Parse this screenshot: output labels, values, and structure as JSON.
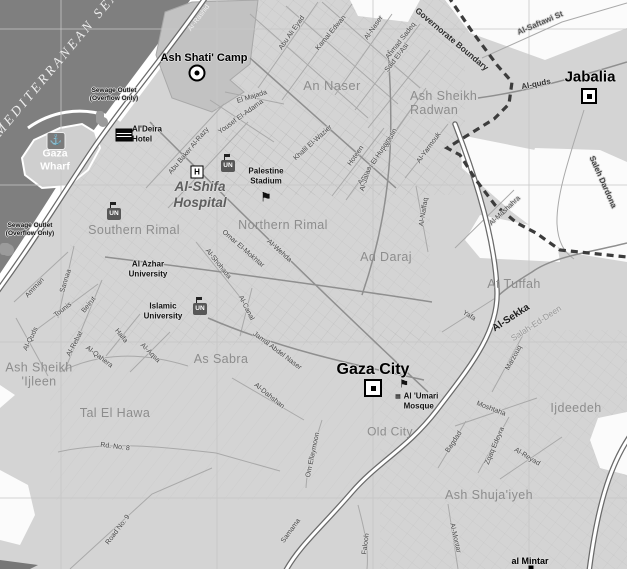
{
  "colors": {
    "sea": "#7f7f7f",
    "land": "#d4d4d4",
    "open_area": "#fbfbfb",
    "camp_area": "#c2c2c2",
    "boundary": "#3c3c3c",
    "major_road": "#ffffff",
    "district_label": "#8d8d8d"
  },
  "sea_label": "MEDITERRANEAN SEA",
  "boundary_label": "Governorate Boundary",
  "icon_labels": {
    "un": "UN",
    "h": "H"
  },
  "districts": [
    {
      "name": "An Naser"
    },
    {
      "name": "Ash Sheikh\nRadwan"
    },
    {
      "name": "Northern Rimal"
    },
    {
      "name": "Southern Rimal"
    },
    {
      "name": "Ad Daraj"
    },
    {
      "name": "At Tuffah"
    },
    {
      "name": "As Sabra"
    },
    {
      "name": "Tal El Hawa"
    },
    {
      "name": "Ash Sheikh\n'Ijleen"
    },
    {
      "name": "Old City"
    },
    {
      "name": "Ijdeedeh"
    },
    {
      "name": "Ash Shuja'iyeh"
    }
  ],
  "places": [
    {
      "name": "Ash Shati' Camp"
    },
    {
      "name": "Jabalia"
    },
    {
      "name": "Gaza City"
    },
    {
      "name": "al Mintar"
    }
  ],
  "pois": [
    {
      "name": "Al'Deira\nHotel"
    },
    {
      "name": "Gaza\nWharf"
    },
    {
      "name": "Sewage Outlet\n(Overflow Only)"
    },
    {
      "name": "Sewage Outlet\n(Overflow Only)"
    },
    {
      "name": "Palestine\nStadium"
    },
    {
      "name": "Al-Shifa\nHospital"
    },
    {
      "name": "Al Azhar\nUniversity"
    },
    {
      "name": "Islamic\nUniversity"
    },
    {
      "name": "Al 'Umari\nMosque"
    }
  ],
  "streets": [
    {
      "name": "Ar-Rashid"
    },
    {
      "name": "Abu Ali Eyad"
    },
    {
      "name": "Kamal Edwan"
    },
    {
      "name": "Al-Naser"
    },
    {
      "name": "Ahmad Sadeq"
    },
    {
      "name": "Said El-Asi"
    },
    {
      "name": "Al-Saftawi St"
    },
    {
      "name": "Al-quds"
    },
    {
      "name": "Saleh Dardona"
    },
    {
      "name": "El Majada"
    },
    {
      "name": "Yousef El-Adama"
    },
    {
      "name": "Khalil El-Wazier"
    },
    {
      "name": "Abu Baker Al-Razy"
    },
    {
      "name": "Falastin"
    },
    {
      "name": "Ameen El Husaini"
    },
    {
      "name": "Hoteen"
    },
    {
      "name": "Al-Yarmouk"
    },
    {
      "name": "Al-Jalaa"
    },
    {
      "name": "Al-Naffaq"
    },
    {
      "name": "Al-Mashahra"
    },
    {
      "name": "Omar El-Mokhtar"
    },
    {
      "name": "Al-Shohada"
    },
    {
      "name": "Al-Wehda"
    },
    {
      "name": "Al-Canal"
    },
    {
      "name": "Sannaa"
    },
    {
      "name": "Amman"
    },
    {
      "name": "Tounis"
    },
    {
      "name": "Beirut"
    },
    {
      "name": "Al-Quds"
    },
    {
      "name": "Al-Rebat"
    },
    {
      "name": "Al-Qahera"
    },
    {
      "name": "Haifa"
    },
    {
      "name": "Al-Aqsa"
    },
    {
      "name": "Jamal Abdel Naser"
    },
    {
      "name": "Al-Dahshan"
    },
    {
      "name": "Om Ellaymoon"
    },
    {
      "name": "Yafa"
    },
    {
      "name": "Al-Sekka"
    },
    {
      "name": "Salah-Ed-Deen"
    },
    {
      "name": "Marzouq"
    },
    {
      "name": "Moshtaha"
    },
    {
      "name": "Bagdad"
    },
    {
      "name": "Zqaq Edeyra"
    },
    {
      "name": "Al-Reyad"
    },
    {
      "name": "Al-Montar"
    },
    {
      "name": "Falooh"
    },
    {
      "name": "Samama"
    },
    {
      "name": "Rd. No. 8"
    },
    {
      "name": "Road No. 9"
    }
  ]
}
